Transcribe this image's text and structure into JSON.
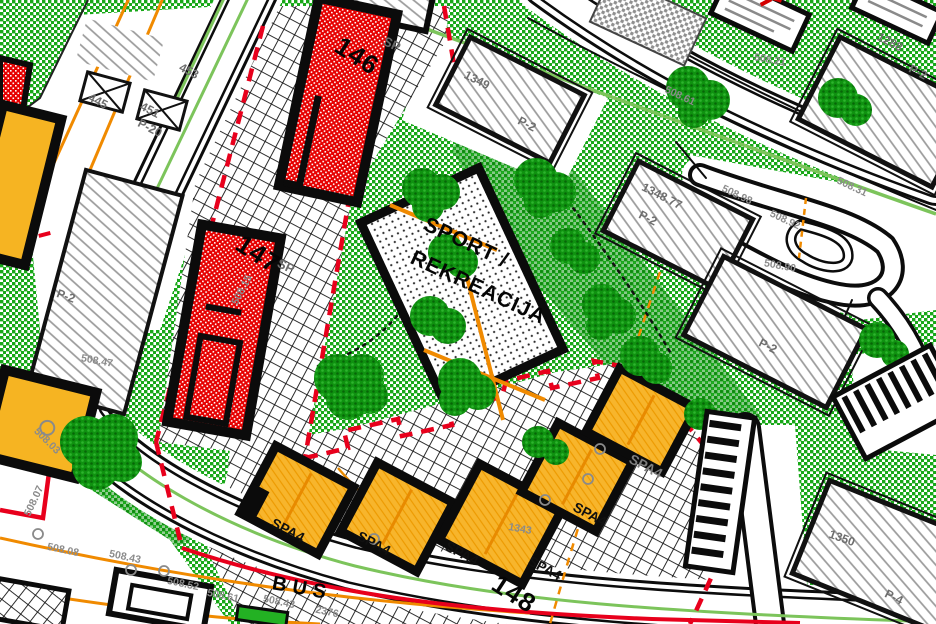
{
  "map": {
    "description": "Urban zoning / land-use plan detail",
    "zones": {
      "sport_recreation": "SPORT / REKREACIJA",
      "spa_zone_code": "SPA4",
      "bus_road_marking": "BUS"
    },
    "colors": {
      "vegetation_green": "#18A818",
      "tree_green": "#0F9210",
      "red_building": "#E60000",
      "orange_building": "#F7B52C",
      "boundary_red": "#E8001C",
      "utility_orange": "#F08A00",
      "boundary_green": "#7CC45B",
      "road_black": "#0C0C0C"
    },
    "labels": [
      {
        "text": "146",
        "x": 357,
        "y": 56,
        "rot": 33,
        "cls": "bignum",
        "name": "building-146-label"
      },
      {
        "text": "147",
        "x": 258,
        "y": 254,
        "rot": 33,
        "cls": "bignum",
        "name": "building-147-label"
      },
      {
        "text": "148",
        "x": 514,
        "y": 594,
        "rot": 33,
        "cls": "bignum",
        "name": "building-148-label"
      },
      {
        "text": "SP",
        "x": 392,
        "y": 44,
        "rot": 25,
        "cls": "sp",
        "name": "sp-zone-label"
      },
      {
        "text": "SP",
        "x": 286,
        "y": 266,
        "rot": 25,
        "cls": "sp",
        "name": "sp-zone-label"
      },
      {
        "text": "SPORT /",
        "x": 466,
        "y": 243,
        "rot": 25,
        "cls": "sport",
        "name": "sport-area-label-line1"
      },
      {
        "text": "REKREACIJA",
        "x": 478,
        "y": 288,
        "rot": 25,
        "cls": "sport",
        "name": "sport-area-label-line2"
      },
      {
        "text": "SPA4",
        "x": 288,
        "y": 530,
        "rot": 28,
        "cls": "spa",
        "name": "spa-building-label"
      },
      {
        "text": "SPA4",
        "x": 374,
        "y": 543,
        "rot": 28,
        "cls": "spa",
        "name": "spa-building-label"
      },
      {
        "text": "SPA4",
        "x": 462,
        "y": 553,
        "rot": 28,
        "cls": "spa",
        "name": "spa-building-label"
      },
      {
        "text": "SPA4",
        "x": 545,
        "y": 568,
        "rot": 28,
        "cls": "spa",
        "name": "spa-building-label"
      },
      {
        "text": "SPA4",
        "x": 590,
        "y": 514,
        "rot": 28,
        "cls": "spa",
        "name": "spa-building-label"
      },
      {
        "text": "SPA4",
        "x": 646,
        "y": 466,
        "rot": 28,
        "cls": "spaGray",
        "name": "spa-building-label"
      },
      {
        "text": "1343",
        "x": 520,
        "y": 529,
        "rot": 10,
        "cls": "el",
        "name": "parcel-number"
      },
      {
        "text": "BUS",
        "x": 302,
        "y": 589,
        "rot": 10,
        "cls": "bus",
        "name": "bus-lane-marking"
      },
      {
        "text": "1349",
        "x": 477,
        "y": 80,
        "rot": 27,
        "cls": "pnum",
        "name": "parcel-number"
      },
      {
        "text": "P-2",
        "x": 527,
        "y": 124,
        "rot": 27,
        "cls": "pnum",
        "name": "parking-label"
      },
      {
        "text": "1288",
        "x": 890,
        "y": 42,
        "rot": 27,
        "cls": "pnum",
        "name": "parcel-number"
      },
      {
        "text": "P-2",
        "x": 918,
        "y": 72,
        "rot": 27,
        "cls": "pnum",
        "name": "parking-label"
      },
      {
        "text": "1348.77",
        "x": 662,
        "y": 196,
        "rot": 27,
        "cls": "pnum",
        "name": "parcel-number"
      },
      {
        "text": "P-2",
        "x": 648,
        "y": 218,
        "rot": 27,
        "cls": "pnum",
        "name": "parking-label"
      },
      {
        "text": "P-2",
        "x": 768,
        "y": 346,
        "rot": 27,
        "cls": "pnum",
        "name": "parking-label"
      },
      {
        "text": "1350",
        "x": 842,
        "y": 538,
        "rot": 20,
        "cls": "pnum",
        "name": "parcel-number"
      },
      {
        "text": "P-4",
        "x": 894,
        "y": 597,
        "rot": 27,
        "cls": "pnum",
        "name": "parking-label"
      },
      {
        "text": "P-2",
        "x": 66,
        "y": 296,
        "rot": 20,
        "cls": "pnum",
        "name": "parking-label"
      },
      {
        "text": "445",
        "x": 98,
        "y": 101,
        "rot": 27,
        "cls": "pnum",
        "name": "parcel-number"
      },
      {
        "text": "453",
        "x": 189,
        "y": 71,
        "rot": 27,
        "cls": "pnum",
        "name": "parcel-number"
      },
      {
        "text": "451",
        "x": 150,
        "y": 110,
        "rot": 27,
        "cls": "pnum",
        "name": "parcel-number"
      },
      {
        "text": "P-20",
        "x": 150,
        "y": 128,
        "rot": 27,
        "cls": "pnum",
        "name": "parking-label"
      },
      {
        "text": "508.21",
        "x": 770,
        "y": 60,
        "rot": 10,
        "cls": "el",
        "name": "elevation-label"
      },
      {
        "text": "508.61",
        "x": 680,
        "y": 96,
        "rot": 25,
        "cls": "el",
        "name": "elevation-label"
      },
      {
        "text": "508.31",
        "x": 852,
        "y": 187,
        "rot": 25,
        "cls": "el",
        "name": "elevation-label"
      },
      {
        "text": "508.98",
        "x": 737,
        "y": 195,
        "rot": 25,
        "cls": "el",
        "name": "elevation-label"
      },
      {
        "text": "508.92",
        "x": 785,
        "y": 220,
        "rot": 25,
        "cls": "el",
        "name": "elevation-label"
      },
      {
        "text": "508.90",
        "x": 780,
        "y": 266,
        "rot": 10,
        "cls": "el",
        "name": "elevation-label"
      },
      {
        "text": "508.15",
        "x": 242,
        "y": 290,
        "rot": -62,
        "cls": "el",
        "name": "elevation-label"
      },
      {
        "text": "508.47",
        "x": 97,
        "y": 361,
        "rot": 10,
        "cls": "el",
        "name": "elevation-label"
      },
      {
        "text": "508.03",
        "x": 47,
        "y": 441,
        "rot": 45,
        "cls": "el",
        "name": "elevation-label"
      },
      {
        "text": "508.07",
        "x": 34,
        "y": 501,
        "rot": -65,
        "cls": "el",
        "name": "elevation-label"
      },
      {
        "text": "508.08",
        "x": 63,
        "y": 550,
        "rot": 12,
        "cls": "el",
        "name": "elevation-label"
      },
      {
        "text": "508.43",
        "x": 125,
        "y": 557,
        "rot": 12,
        "cls": "el",
        "name": "elevation-label"
      },
      {
        "text": "508.52",
        "x": 183,
        "y": 584,
        "rot": 12,
        "cls": "el",
        "name": "elevation-label"
      },
      {
        "text": "508.61",
        "x": 223,
        "y": 596,
        "rot": 12,
        "cls": "el",
        "name": "elevation-label"
      },
      {
        "text": "508.43",
        "x": 279,
        "y": 602,
        "rot": 12,
        "cls": "el",
        "name": "elevation-label"
      },
      {
        "text": "2376",
        "x": 327,
        "y": 612,
        "rot": 12,
        "cls": "el",
        "name": "parcel-number"
      }
    ]
  }
}
